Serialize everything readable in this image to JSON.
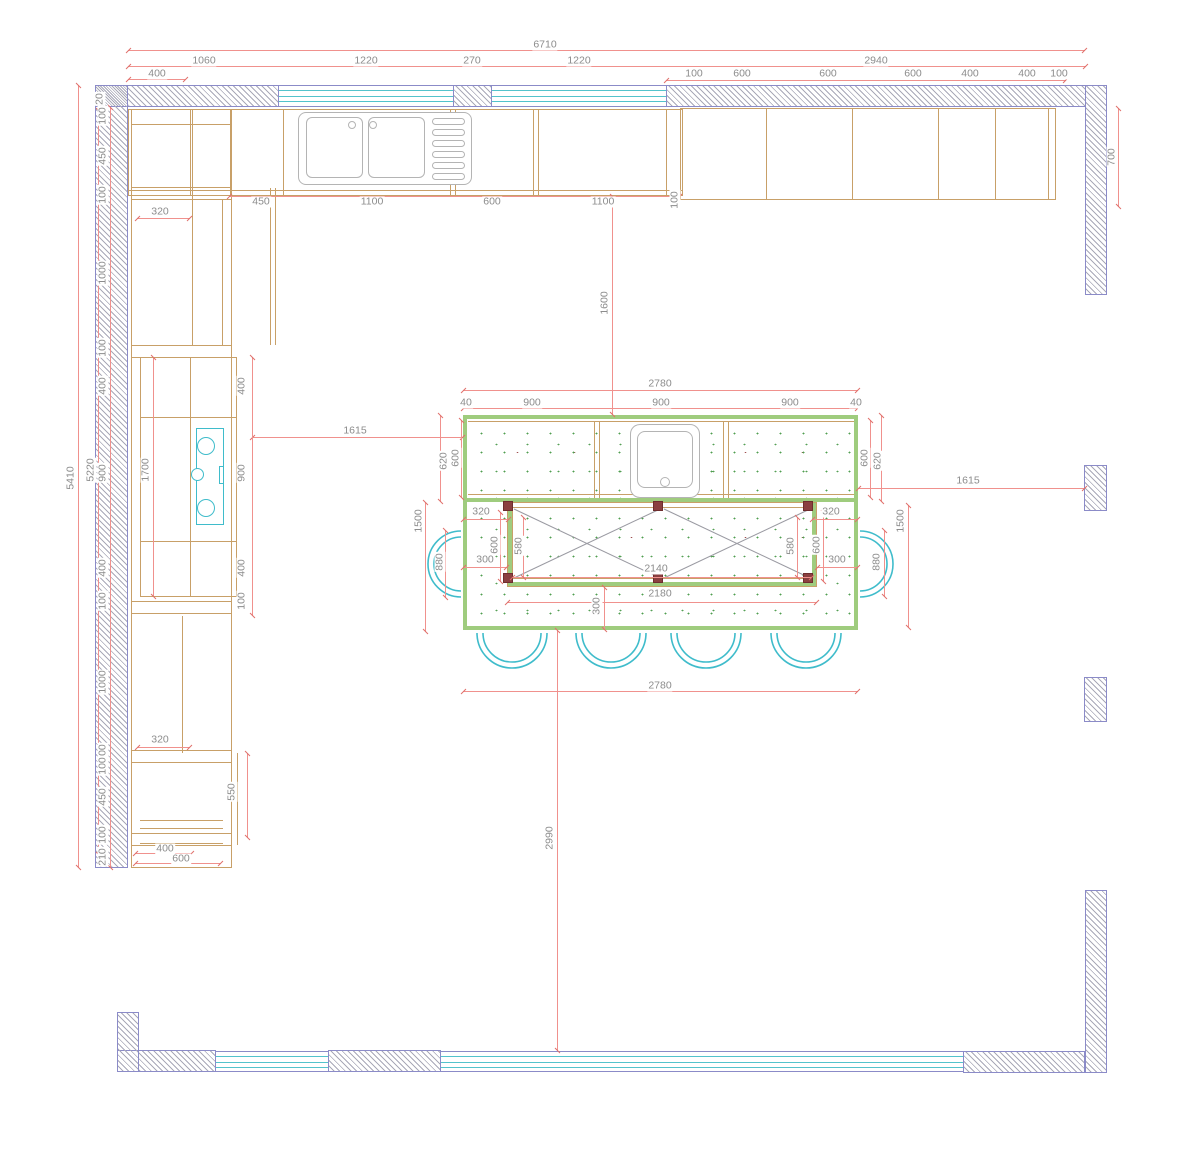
{
  "drawing": {
    "kind": "kitchen floor plan",
    "colors": {
      "dimension_line": "#f0918d",
      "dimension_text": "#8c8c8c",
      "cabinet_line": "#c8a068",
      "wall_outline": "#8b8bc8",
      "wall_hatch": "#a9a9b8",
      "window_glass": "#53c3cc",
      "chair": "#3fbccb",
      "island_edge": "#9fcc7e",
      "speckle": "#4f9e4f",
      "post": "#8b4040",
      "appliance": "#b4b4b4"
    }
  },
  "dims": [
    {
      "t": "6710",
      "x": 545,
      "y": 45
    },
    {
      "t": "1060",
      "x": 204,
      "y": 61
    },
    {
      "t": "1220",
      "x": 366,
      "y": 61
    },
    {
      "t": "270",
      "x": 472,
      "y": 61
    },
    {
      "t": "1220",
      "x": 579,
      "y": 61
    },
    {
      "t": "2940",
      "x": 876,
      "y": 61
    },
    {
      "t": "400",
      "x": 157,
      "y": 74
    },
    {
      "t": "100",
      "x": 694,
      "y": 74
    },
    {
      "t": "600",
      "x": 742,
      "y": 74
    },
    {
      "t": "600",
      "x": 828,
      "y": 74
    },
    {
      "t": "600",
      "x": 913,
      "y": 74
    },
    {
      "t": "400",
      "x": 970,
      "y": 74
    },
    {
      "t": "400",
      "x": 1027,
      "y": 74
    },
    {
      "t": "100",
      "x": 1059,
      "y": 74
    },
    {
      "t": "700",
      "x": 1112,
      "y": 157,
      "r": 1
    },
    {
      "t": "5410",
      "x": 71,
      "y": 478,
      "r": 1
    },
    {
      "t": "5220",
      "x": 91,
      "y": 470,
      "r": 1
    },
    {
      "t": "20",
      "x": 100,
      "y": 99,
      "r": 1
    },
    {
      "t": "100",
      "x": 103,
      "y": 116,
      "r": 1
    },
    {
      "t": "450",
      "x": 103,
      "y": 156,
      "r": 1
    },
    {
      "t": "100",
      "x": 103,
      "y": 195,
      "r": 1
    },
    {
      "t": "1000",
      "x": 103,
      "y": 273,
      "r": 1
    },
    {
      "t": "100",
      "x": 103,
      "y": 348,
      "r": 1
    },
    {
      "t": "400",
      "x": 103,
      "y": 386,
      "r": 1
    },
    {
      "t": "900",
      "x": 103,
      "y": 473,
      "r": 1
    },
    {
      "t": "400",
      "x": 103,
      "y": 568,
      "r": 1
    },
    {
      "t": "100",
      "x": 103,
      "y": 601,
      "r": 1
    },
    {
      "t": "1000",
      "x": 103,
      "y": 682,
      "r": 1
    },
    {
      "t": "100",
      "x": 103,
      "y": 753,
      "r": 1
    },
    {
      "t": "100",
      "x": 103,
      "y": 766,
      "r": 1
    },
    {
      "t": "450",
      "x": 103,
      "y": 797,
      "r": 1
    },
    {
      "t": "100",
      "x": 103,
      "y": 835,
      "r": 1
    },
    {
      "t": "210",
      "x": 103,
      "y": 857,
      "r": 1
    },
    {
      "t": "320",
      "x": 160,
      "y": 212
    },
    {
      "t": "450",
      "x": 261,
      "y": 202
    },
    {
      "t": "1100",
      "x": 372,
      "y": 202
    },
    {
      "t": "600",
      "x": 492,
      "y": 202
    },
    {
      "t": "1100",
      "x": 603,
      "y": 202
    },
    {
      "t": "100",
      "x": 675,
      "y": 200,
      "r": 1
    },
    {
      "t": "400",
      "x": 242,
      "y": 386,
      "r": 1
    },
    {
      "t": "900",
      "x": 242,
      "y": 473,
      "r": 1
    },
    {
      "t": "400",
      "x": 242,
      "y": 568,
      "r": 1
    },
    {
      "t": "100",
      "x": 242,
      "y": 601,
      "r": 1
    },
    {
      "t": "1700",
      "x": 146,
      "y": 470,
      "r": 1
    },
    {
      "t": "1615",
      "x": 355,
      "y": 431
    },
    {
      "t": "1615",
      "x": 968,
      "y": 481
    },
    {
      "t": "1600",
      "x": 605,
      "y": 303,
      "r": 1
    },
    {
      "t": "2780",
      "x": 660,
      "y": 384
    },
    {
      "t": "40",
      "x": 466,
      "y": 403
    },
    {
      "t": "900",
      "x": 532,
      "y": 403
    },
    {
      "t": "900",
      "x": 661,
      "y": 403
    },
    {
      "t": "900",
      "x": 790,
      "y": 403
    },
    {
      "t": "40",
      "x": 856,
      "y": 403
    },
    {
      "t": "620",
      "x": 444,
      "y": 461,
      "r": 1
    },
    {
      "t": "600",
      "x": 456,
      "y": 458,
      "r": 1
    },
    {
      "t": "600",
      "x": 865,
      "y": 458,
      "r": 1
    },
    {
      "t": "620",
      "x": 878,
      "y": 461,
      "r": 1
    },
    {
      "t": "320",
      "x": 481,
      "y": 512
    },
    {
      "t": "320",
      "x": 831,
      "y": 512
    },
    {
      "t": "1500",
      "x": 419,
      "y": 521,
      "r": 1
    },
    {
      "t": "1500",
      "x": 901,
      "y": 521,
      "r": 1
    },
    {
      "t": "880",
      "x": 440,
      "y": 562,
      "r": 1
    },
    {
      "t": "880",
      "x": 877,
      "y": 562,
      "r": 1
    },
    {
      "t": "600",
      "x": 495,
      "y": 545,
      "r": 1
    },
    {
      "t": "580",
      "x": 519,
      "y": 546,
      "r": 1
    },
    {
      "t": "580",
      "x": 791,
      "y": 546,
      "r": 1
    },
    {
      "t": "600",
      "x": 817,
      "y": 545,
      "r": 1
    },
    {
      "t": "300",
      "x": 485,
      "y": 560
    },
    {
      "t": "300",
      "x": 837,
      "y": 560
    },
    {
      "t": "2140",
      "x": 656,
      "y": 569
    },
    {
      "t": "2180",
      "x": 660,
      "y": 594
    },
    {
      "t": "300",
      "x": 597,
      "y": 606,
      "r": 1
    },
    {
      "t": "2780",
      "x": 660,
      "y": 686
    },
    {
      "t": "2990",
      "x": 550,
      "y": 838,
      "r": 1
    },
    {
      "t": "320",
      "x": 160,
      "y": 740
    },
    {
      "t": "550",
      "x": 232,
      "y": 792,
      "r": 1
    },
    {
      "t": "400",
      "x": 165,
      "y": 849
    },
    {
      "t": "600",
      "x": 181,
      "y": 859
    }
  ]
}
